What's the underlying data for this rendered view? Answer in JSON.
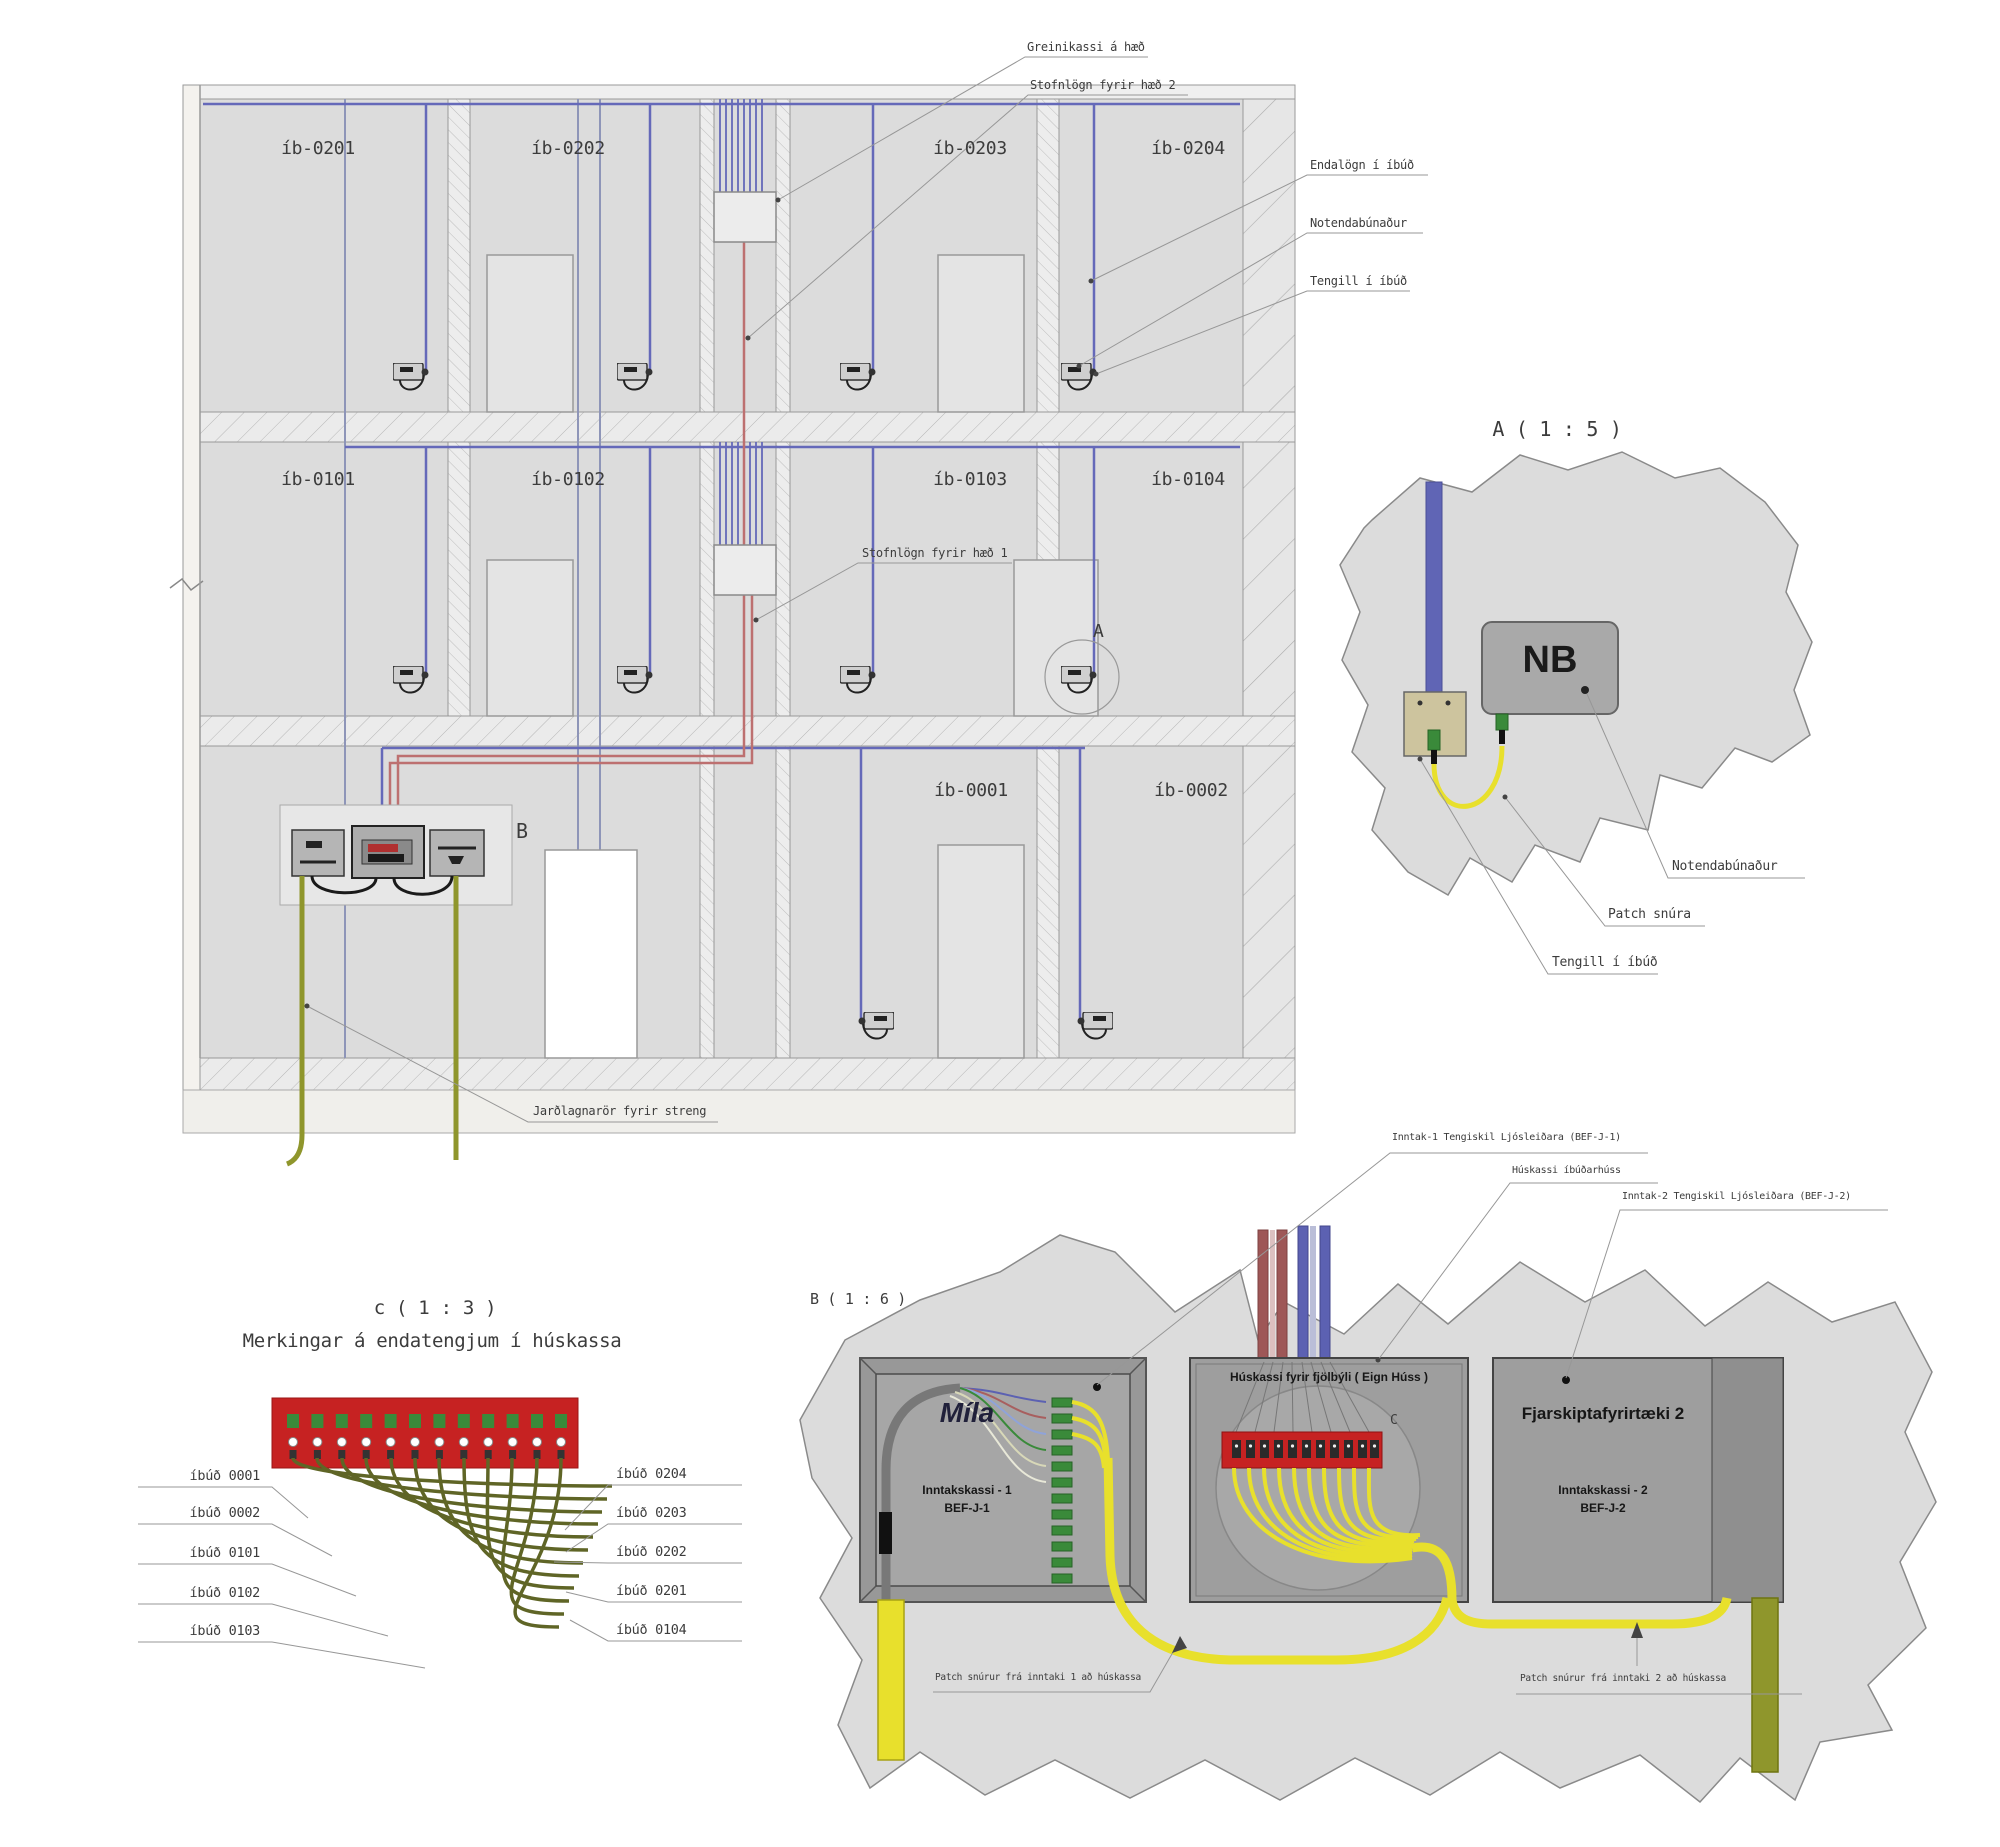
{
  "drawing": {
    "apartments_floor2": [
      "íb-0201",
      "íb-0202",
      "íb-0203",
      "íb-0204"
    ],
    "apartments_floor1": [
      "íb-0101",
      "íb-0102",
      "íb-0103",
      "íb-0104"
    ],
    "apartments_ground": [
      "íb-0001",
      "íb-0002"
    ],
    "callouts": {
      "greinikassi": "Greinikassi á hæð",
      "stofnlogn_haed2": "Stofnlögn fyrir hæð 2",
      "endalogn": "Endalögn í íbúð",
      "notendabunadur": "Notendabúnaður",
      "tengill": "Tengill í íbúð",
      "stofnlogn_haed1": "Stofnlögn fyrir hæð 1",
      "jardlagnaror": "Jarðlagnarör fyrir streng"
    },
    "markers": {
      "detail_a": "A",
      "detail_b": "B"
    }
  },
  "detail_a": {
    "title": "A ( 1 : 5 )",
    "nb_box": "NB",
    "callouts": {
      "notendabunadur": "Notendabúnaður",
      "patch_snura": "Patch snúra",
      "tengill": "Tengill í íbúð"
    }
  },
  "detail_c": {
    "title": "c ( 1 : 3 )",
    "subtitle": "Merkingar á endatengjum í húskassa",
    "left_labels": [
      "íbúð 0001",
      "íbúð 0002",
      "íbúð 0101",
      "íbúð 0102",
      "íbúð 0103"
    ],
    "right_labels": [
      "íbúð 0204",
      "íbúð 0203",
      "íbúð 0202",
      "íbúð 0201",
      "íbúð 0104"
    ]
  },
  "detail_b": {
    "title": "B ( 1 : 6 )",
    "callouts": {
      "inntak1": "Inntak-1 Tengiskil Ljósleiðara (BEF-J-1)",
      "huskassi": "Húskassi íbúðarhúss",
      "inntak2": "Inntak-2 Tengiskil Ljósleiðara (BEF-J-2)",
      "patch1": "Patch snúrur frá inntaki 1 að húskassa",
      "patch2": "Patch snúrur frá inntaki 2 að húskassa"
    },
    "box_mila": {
      "brand": "Míla",
      "line1": "Inntakskassi - 1",
      "line2": "BEF-J-1"
    },
    "box_huskassi": {
      "title": "Húskassi fyrir fjölbýli ( Eign Húss )",
      "marker": "C"
    },
    "box_fjarskipta": {
      "title": "Fjarskiptafyrirtæki 2",
      "line1": "Inntakskassi - 2",
      "line2": "BEF-J-2"
    }
  },
  "colors": {
    "cable_blue": "#6569b9",
    "cable_red": "#bd7070",
    "patch_yellow": "#e8e02c",
    "conduit_olive": "#8f962c",
    "terminal_red": "#c62222",
    "connector_green": "#3a8a3a"
  }
}
